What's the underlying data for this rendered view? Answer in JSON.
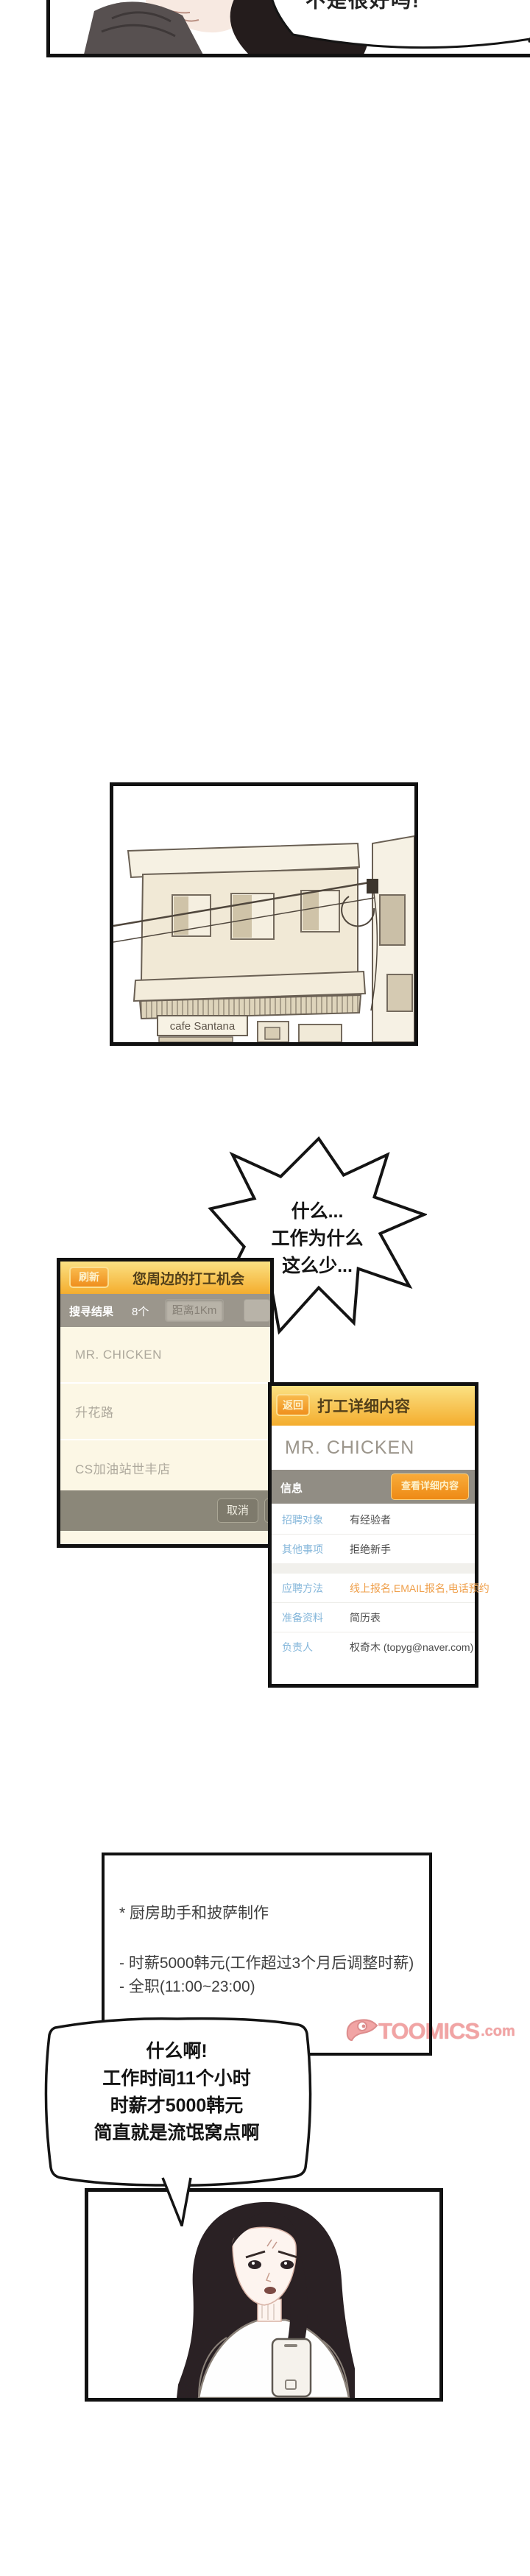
{
  "bubbles": {
    "top_partial": "不是很好吗!",
    "shock": [
      "什么...",
      "工作为什么",
      "这么少..."
    ],
    "reaction": [
      "什么啊!",
      "工作时间11个小时",
      "时薪才5000韩元",
      "简直就是流氓窝点啊"
    ]
  },
  "building": {
    "sign": "cafe Santana"
  },
  "job_list_app": {
    "refresh_button": "刷新",
    "title": "您周边的打工机会",
    "results_label": "搜寻结果",
    "results_count": "8个",
    "distance_filter_button": "距离1Km",
    "items": [
      "MR. CHICKEN",
      "升花路",
      "CS加油站世丰店"
    ],
    "cancel_button": "取消"
  },
  "job_detail_app": {
    "back_button": "返回",
    "title": "打工详细内容",
    "store_name": "MR. CHICKEN",
    "section_label": "信息",
    "view_detail_button": "查看详细内容",
    "rows": [
      {
        "label": "招聘对象",
        "value": "有经验者"
      },
      {
        "label": "其他事项",
        "value": "拒绝新手"
      },
      {
        "label": "应聘方法",
        "value": "线上报名,EMAIL报名,电话预约",
        "highlight": true,
        "gap": true
      },
      {
        "label": "准备资料",
        "value": "简历表"
      },
      {
        "label": "负责人",
        "value": "权奇木 (topyg@naver.com)"
      }
    ]
  },
  "job_note_lines": [
    "* 厨房助手和披萨制作",
    "- 时薪5000韩元(工作超过3个月后调整时薪)",
    "- 全职(11:00~23:00)"
  ],
  "watermark": {
    "brand": "TOOMICS",
    "domain": ".com"
  },
  "colors": {
    "app_header_gold": "#f4ad2e",
    "app_button_orange": "#ef8f1d",
    "subheader_gray": "#9b968c",
    "list_bg_cream": "#fcf7e5",
    "detail_label_blue": "#84b6da",
    "detail_value_orange": "#ef9f4a",
    "watermark_pink": "#f1a4a4"
  }
}
